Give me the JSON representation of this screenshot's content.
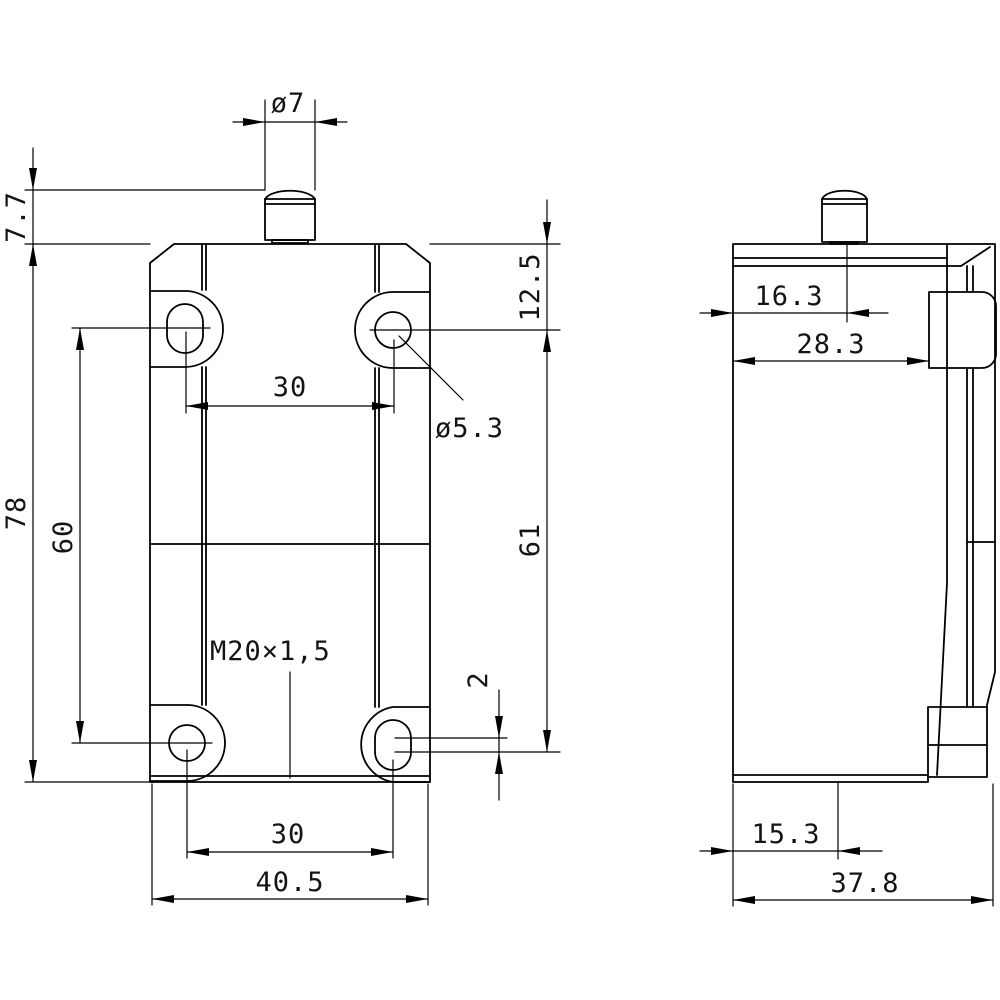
{
  "drawing": {
    "kind": "technical-dimension-drawing",
    "background": "#ffffff",
    "line_color": "#000000",
    "front_view": {
      "dims": {
        "plunger_dia": "ø7",
        "plunger_proj": "7.7",
        "top_edge_to_hole": "12.5",
        "top_hole_pitch": "30",
        "mount_hole_dia": "ø5.3",
        "body_height": "78",
        "hole_pitch_v": "60",
        "hole_span_v": "61",
        "conduit_thread": "M20×1,5",
        "slot_elongation": "2",
        "bottom_hole_pitch": "30",
        "body_width": "40.5"
      }
    },
    "side_view": {
      "dims": {
        "plunger_offset": "16.3",
        "head_depth": "28.3",
        "conduit_offset": "15.3",
        "body_depth": "37.8"
      }
    }
  }
}
